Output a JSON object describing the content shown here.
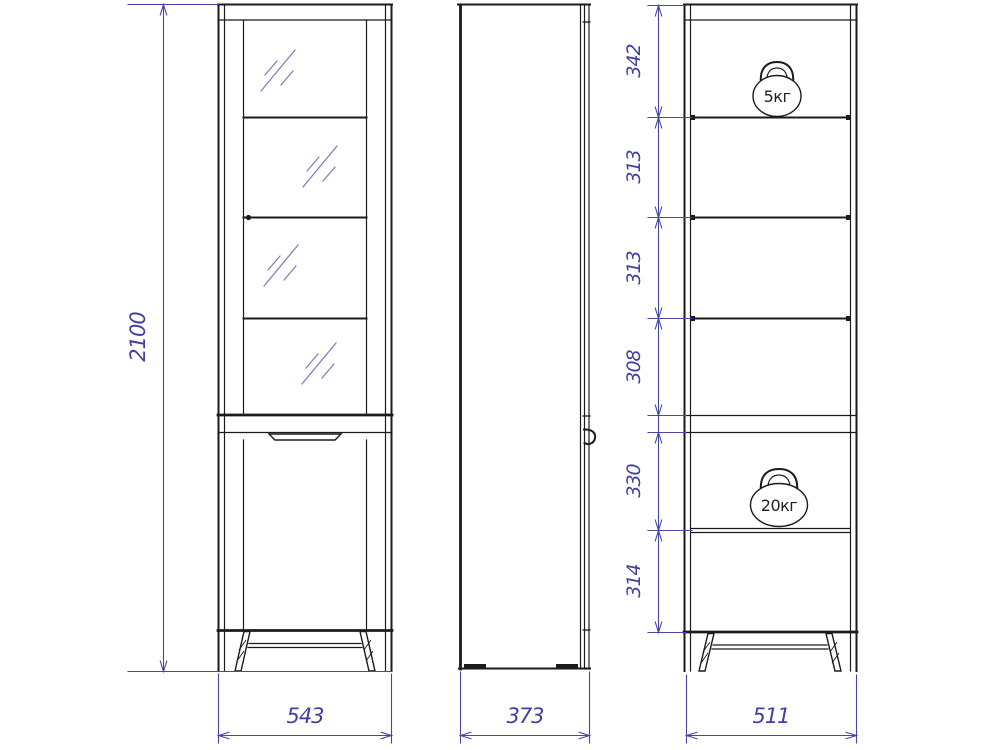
{
  "drawing": {
    "type": "furniture-technical-drawing",
    "background_color": "#ffffff",
    "outline_color": "#1b1b1b",
    "dimension_color": "#4646a8",
    "glass_hatch_color": "#8080bd",
    "front_view": {
      "label": "front view with glass door",
      "overall_height": "2100",
      "overall_width": "543"
    },
    "side_view": {
      "label": "side view",
      "overall_depth": "373"
    },
    "internal_view": {
      "label": "internal shelf view",
      "overall_width": "511",
      "sections": [
        "342",
        "313",
        "313",
        "308",
        "330",
        "314"
      ],
      "upper_weight": "5кг",
      "lower_weight": "20кг"
    }
  }
}
